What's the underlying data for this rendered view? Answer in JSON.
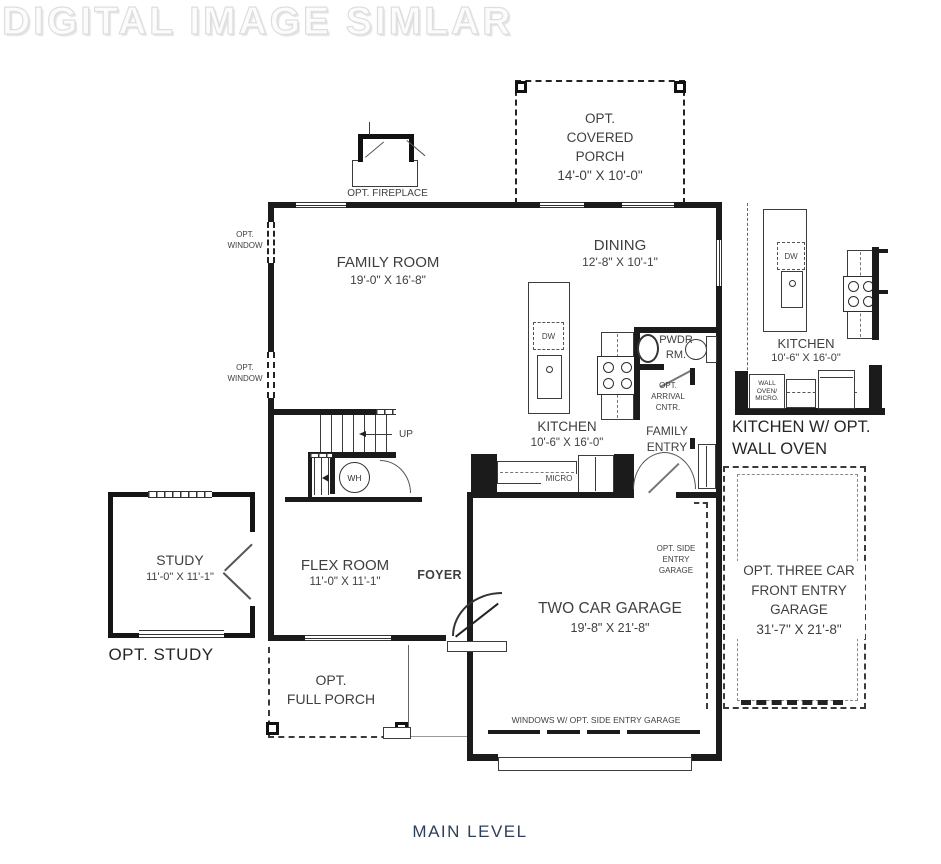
{
  "watermark": "DIGITAL IMAGE SIMLAR",
  "title": "MAIN LEVEL",
  "colors": {
    "title": "#2e3f5c",
    "wall": "#1b1b1b",
    "text": "#3f3f3f"
  },
  "rooms": {
    "covered_porch": {
      "label": "OPT.\nCOVERED\nPORCH\n14'-0\" X 10'-0\""
    },
    "family_room": {
      "name": "FAMILY ROOM",
      "dims": "19'-0\" X 16'-8\""
    },
    "dining": {
      "name": "DINING",
      "dims": "12'-8\" X 10'-1\""
    },
    "kitchen": {
      "name": "KITCHEN",
      "dims": "10'-6\" X 16'-0\""
    },
    "powder_room": {
      "name": "PWDR\nRM."
    },
    "family_entry": {
      "name": "FAMILY\nENTRY"
    },
    "foyer": {
      "name": "FOYER"
    },
    "flex_room": {
      "name": "FLEX ROOM",
      "dims": "11'-0\" X 11'-1\""
    },
    "study": {
      "name": "STUDY",
      "dims": "11'-0\" X 11'-1\"",
      "caption": "OPT. STUDY"
    },
    "two_car_garage": {
      "name": "TWO CAR GARAGE",
      "dims": "19'-8\" X 21'-8\""
    },
    "three_car_garage": {
      "label": "OPT. THREE CAR\nFRONT ENTRY\nGARAGE\n31'-7\" X 21'-8\""
    },
    "full_porch": {
      "label": "OPT.\nFULL PORCH"
    },
    "kitchen_inset": {
      "name": "KITCHEN",
      "dims": "10'-6\" X 16'-0\"",
      "caption": "KITCHEN W/ OPT.\nWALL OVEN"
    }
  },
  "annotations": {
    "opt_fireplace": "OPT. FIREPLACE",
    "opt_window_upper": "OPT.\nWINDOW",
    "opt_window_lower": "OPT.\nWINDOW",
    "opt_arrival_cntr": "OPT.\nARRIVAL\nCNTR.",
    "opt_side_entry": "OPT. SIDE\nENTRY\nGARAGE",
    "windows_note": "WINDOWS W/ OPT. SIDE ENTRY GARAGE",
    "up": "UP",
    "wh": "WH",
    "micro": "MICRO",
    "dw_main": "DW",
    "dw_inset": "DW",
    "wall_oven_micro": "WALL\nOVEN/\nMICRO."
  }
}
